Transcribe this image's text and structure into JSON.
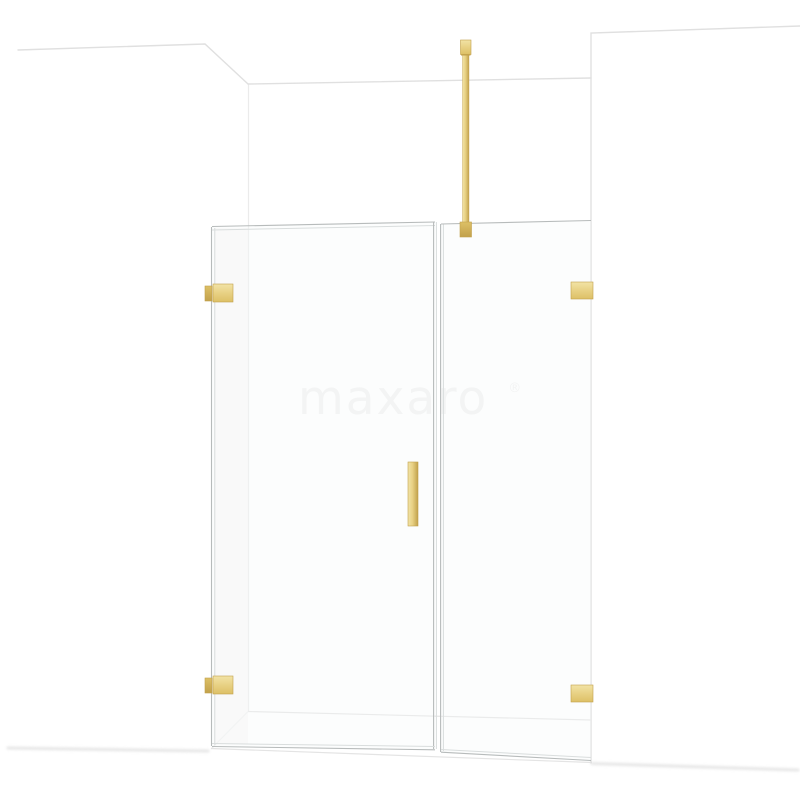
{
  "watermark": {
    "text": "maxaro",
    "registered_mark": "®"
  },
  "colors": {
    "wall_line": "#e0e0e0",
    "wall_line_soft": "#ebebeb",
    "floor_line": "#e4e4e4",
    "shadow_line": "#d9d9d9",
    "glass_edge": "#b7bbbb",
    "glass_edge_light": "#d9dddd",
    "glass_fill": "#f7fafa",
    "reveal_shade": "#f5f5f5",
    "gold_light": "#f2e3a6",
    "gold_base": "#e8d184",
    "gold_mid": "#ddc066",
    "gold_dark": "#c2a14b",
    "watermark_color": "#f1f1f1"
  }
}
